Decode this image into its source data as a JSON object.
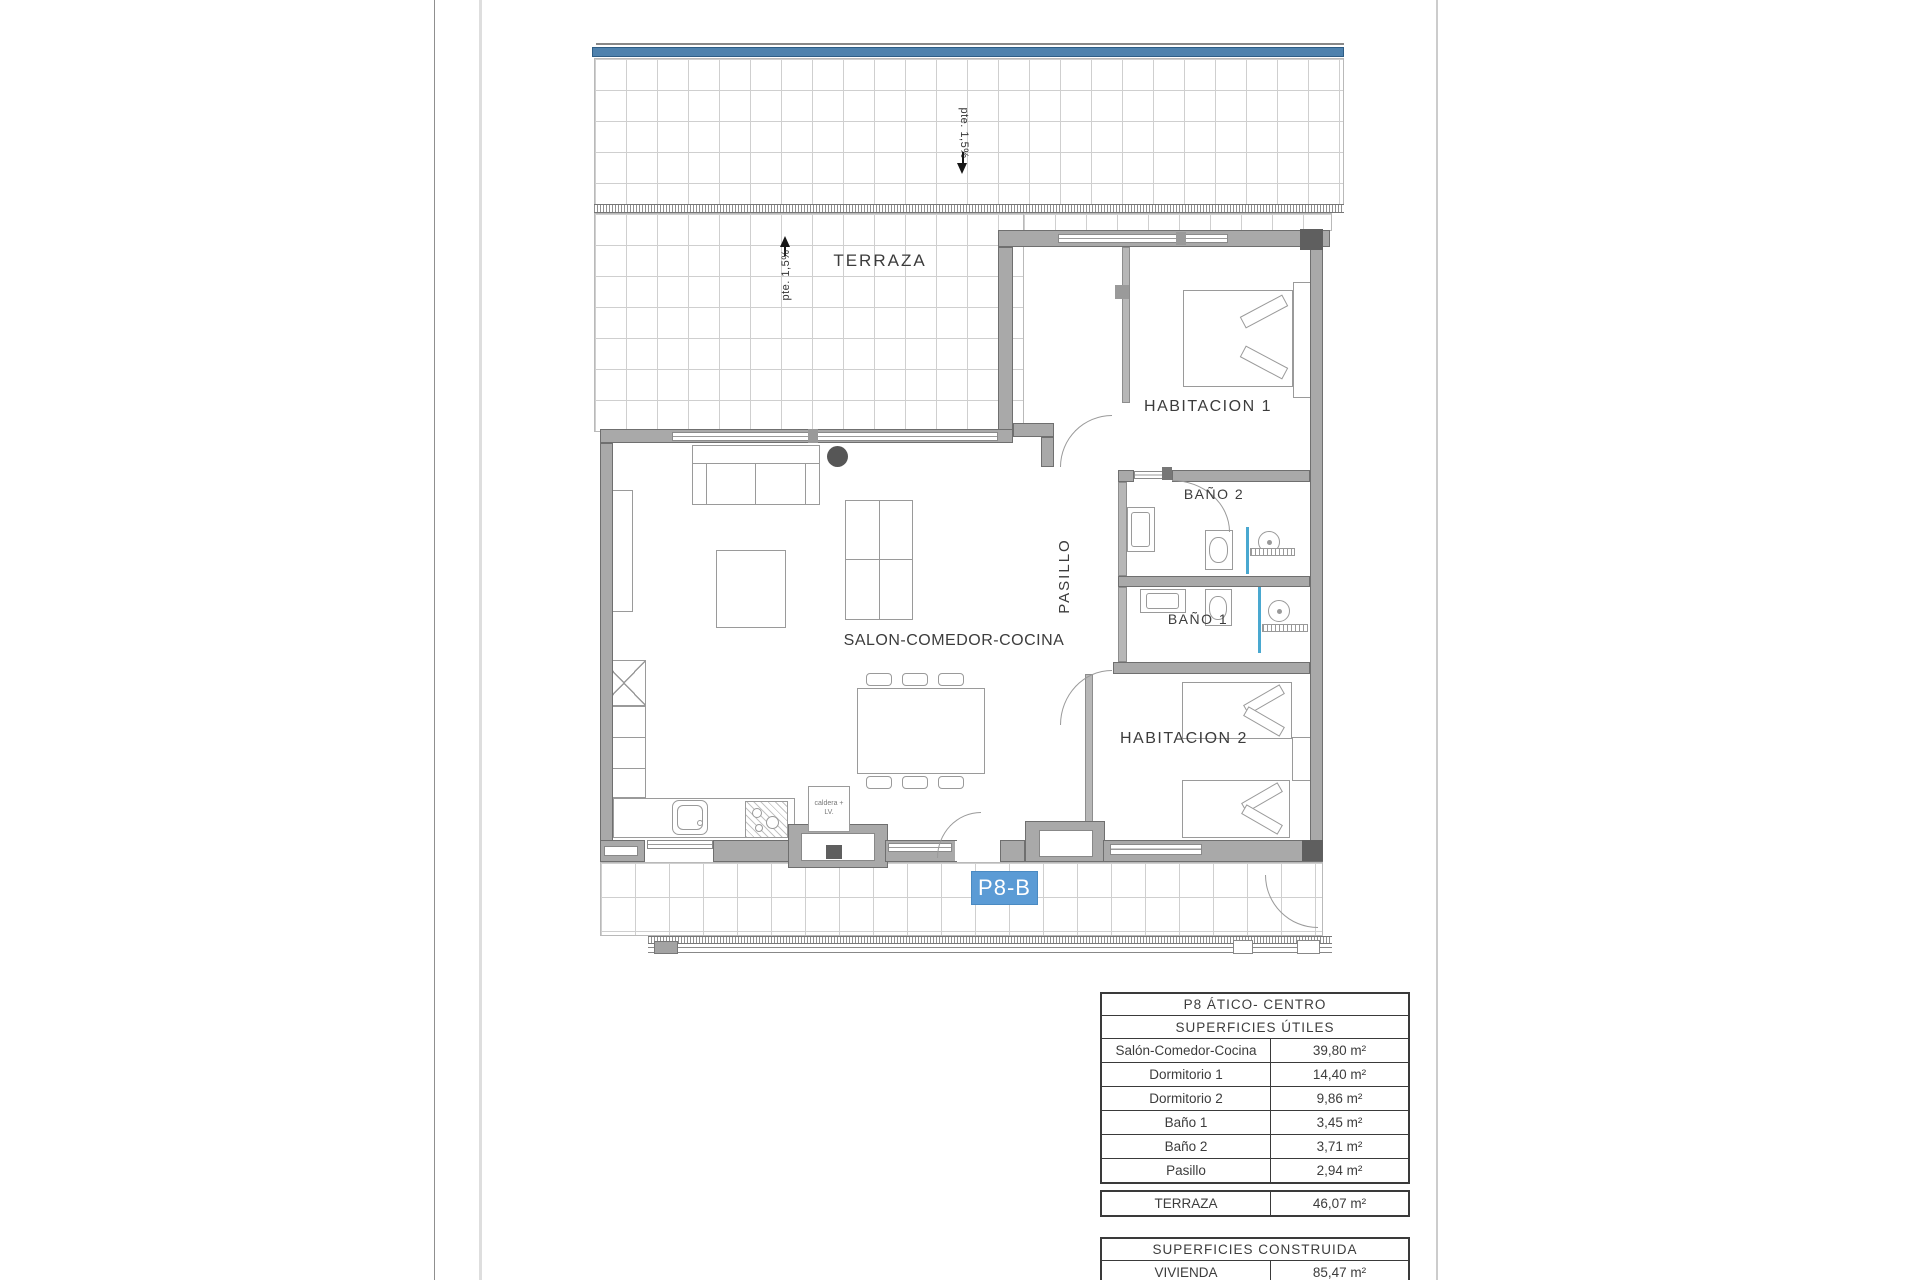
{
  "plan": {
    "unit_label": "P8-B",
    "labels": {
      "terraza": "TERRAZA",
      "habitacion1": "HABITACION 1",
      "habitacion2": "HABITACION 2",
      "bano1": "BAÑO 1",
      "bano2": "BAÑO 2",
      "pasillo": "PASILLO",
      "salon": "SALON-COMEDOR-COCINA",
      "slope_top": "pte. 1,5%",
      "slope_left": "pte. 1,5%",
      "utility_box": "caldera + LV."
    },
    "colors": {
      "unit_badge_blue": "#5b9bd5",
      "parapet_band_blue": "#4e81ad",
      "shower_screen_blue": "#49a8d0",
      "wall_gray": "#a9a9a9"
    }
  },
  "area_tables": {
    "main": {
      "title": "P8 ÁTICO- CENTRO",
      "subtitle": "SUPERFICIES ÚTILES",
      "rows": [
        {
          "label": "Salón-Comedor-Cocina",
          "value": "39,80 m²"
        },
        {
          "label": "Dormitorio 1",
          "value": "14,40 m²"
        },
        {
          "label": "Dormitorio 2",
          "value": "9,86 m²"
        },
        {
          "label": "Baño 1",
          "value": "3,45 m²"
        },
        {
          "label": "Baño 2",
          "value": "3,71 m²"
        },
        {
          "label": "Pasillo",
          "value": "2,94 m²"
        }
      ]
    },
    "terraza_row": {
      "label": "TERRAZA",
      "value": "46,07 m²"
    },
    "construida": {
      "title": "SUPERFICIES CONSTRUIDA",
      "rows": [
        {
          "label": "VIVIENDA",
          "value": "85,47 m²"
        }
      ]
    }
  }
}
